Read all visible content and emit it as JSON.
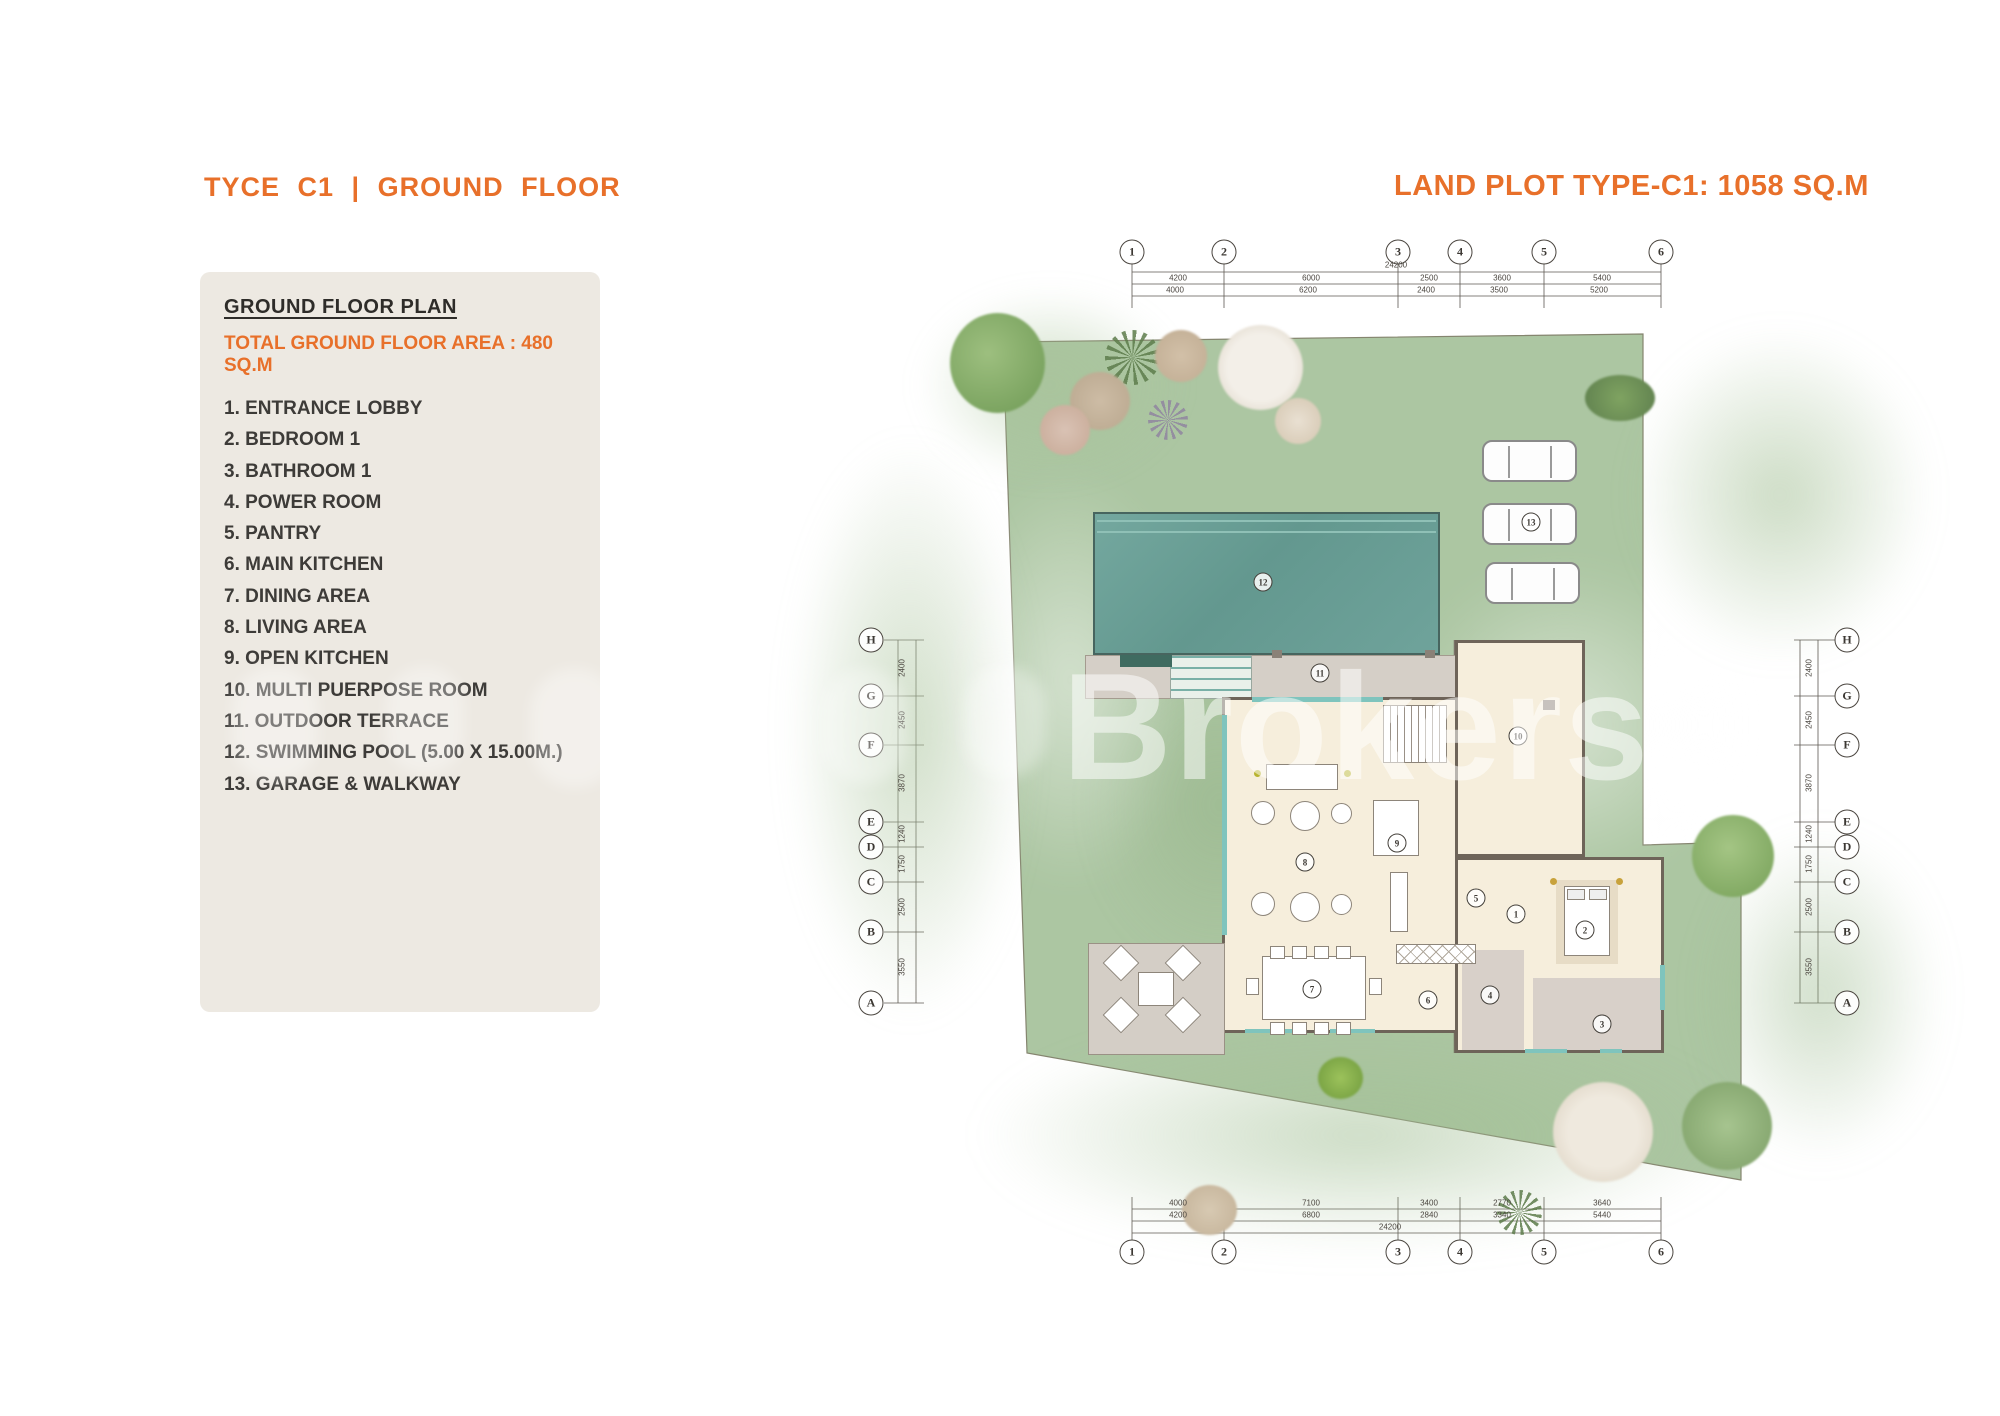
{
  "header": {
    "left_title": "TYCE C1 | GROUND FLOOR",
    "right_title": "LAND PLOT TYPE-C1: 1058 SQ.M",
    "accent_color": "#E8702A"
  },
  "legend": {
    "heading": "GROUND FLOOR PLAN",
    "total_line": "TOTAL GROUND FLOOR AREA : 480 SQ.M",
    "items": [
      "1. ENTRANCE LOBBY",
      "2. BEDROOM 1",
      "3. BATHROOM 1",
      "4. POWER ROOM",
      "5. PANTRY",
      "6. MAIN KITCHEN",
      "7. DINING AREA",
      "8. LIVING AREA",
      "9. OPEN KITCHEN",
      "10. MULTI PUERPOSE ROOM",
      "11. OUTDOOR TERRACE",
      "12. SWIMMING POOL (5.00 X 15.00M.)",
      "13. GARAGE & WALKWAY"
    ]
  },
  "watermark": {
    "text": "Brokers"
  },
  "plan": {
    "colors": {
      "ground_green": "#ACC6A2",
      "pool_teal": "#6FA39B",
      "house_cream": "#F6EEDC",
      "terrace_gray": "#D4CEC6",
      "wall": "#6E6459"
    },
    "grid": {
      "top_labels": [
        "1",
        "2",
        "3",
        "4",
        "5",
        "6"
      ],
      "bottom_labels": [
        "1",
        "2",
        "3",
        "4",
        "5",
        "6"
      ],
      "left_labels": [
        "H",
        "G",
        "F",
        "E",
        "D",
        "C",
        "B",
        "A"
      ],
      "right_labels": [
        "H",
        "G",
        "F",
        "E",
        "D",
        "C",
        "B",
        "A"
      ]
    },
    "dimensions": {
      "top_total": "24200",
      "top_segments": [
        "4200",
        "6000",
        "2500",
        "3600",
        "5400"
      ],
      "top_subsegments": [
        "4000",
        "6200",
        "2400",
        "3500",
        "5200"
      ],
      "bottom_row1": [
        "4000",
        "7100",
        "3400",
        "2770",
        "3640"
      ],
      "bottom_row2": [
        "4200",
        "6800",
        "2840",
        "3340",
        "5440"
      ],
      "bottom_total": "24200",
      "side_segments_left": [
        "2400",
        "2450",
        "3870",
        "1240",
        "1750",
        "2500",
        "3550"
      ],
      "side_segments_right": [
        "2400",
        "2450",
        "3870",
        "1240",
        "1750",
        "2500",
        "3550"
      ]
    },
    "room_labels": [
      {
        "num": "1"
      },
      {
        "num": "2"
      },
      {
        "num": "3"
      },
      {
        "num": "4"
      },
      {
        "num": "5"
      },
      {
        "num": "6"
      },
      {
        "num": "7"
      },
      {
        "num": "8"
      },
      {
        "num": "9"
      },
      {
        "num": "10"
      },
      {
        "num": "11"
      },
      {
        "num": "12"
      },
      {
        "num": "13"
      }
    ]
  }
}
